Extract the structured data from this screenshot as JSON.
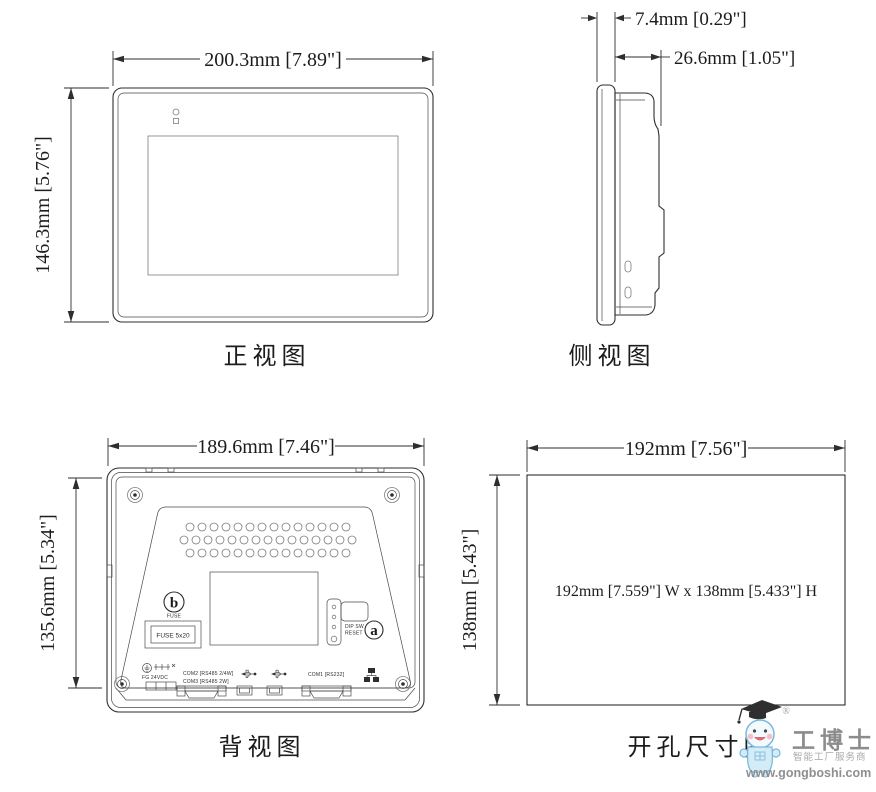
{
  "page": {
    "background": "#ffffff",
    "line_color": "#2e2e2e"
  },
  "views": {
    "front": {
      "caption": "正视图",
      "width_label": "200.3mm [7.89\"]",
      "height_label": "146.3mm [5.76\"]"
    },
    "side": {
      "caption": "侧视图",
      "bezel_depth_label": "7.4mm [0.29\"]",
      "total_depth_label": "26.6mm [1.05\"]"
    },
    "back": {
      "caption": "背视图",
      "width_label": "189.6mm [7.46\"]",
      "height_label": "135.6mm [5.34\"]",
      "fuse_callout_letter": "b",
      "fuse_callout_caption": "FUSE",
      "fuse_box_label": "FUSE 5x20",
      "dip_label_line1": "DIP SW",
      "dip_label_line2": "RESET",
      "dip_callout_letter": "a",
      "power_label": "FG  24VDC",
      "com2_label": "COM2 [RS485 2/4W]",
      "com3_label": "COM3 [RS485 2W]",
      "com1_label": "COM1 [RS232]"
    },
    "cutout": {
      "caption": "开孔尺寸图",
      "width_label": "192mm [7.56\"]",
      "height_label": "138mm [5.43\"]",
      "center_label": "192mm [7.559\"] W x 138mm [5.433\"] H"
    }
  },
  "watermark": {
    "registered": "®",
    "brand": "工博士",
    "tagline": "智能工厂服务商",
    "url": "www.gongboshi.com",
    "brand_color": "#8c8c8c",
    "mascot_body_color": "#d4ecf8",
    "mascot_outline_color": "#79b8d8",
    "mascot_cap_color": "#2f2f2f",
    "mascot_cheek_color": "#f5bfc8"
  }
}
